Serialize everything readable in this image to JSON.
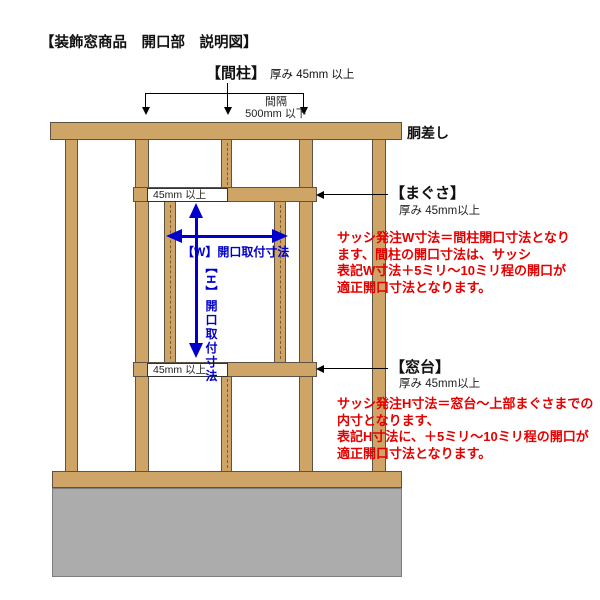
{
  "title": "【装飾窓商品　開口部　説明図】",
  "colors": {
    "wood": "#cfa567",
    "foundation": "#acacac",
    "dimension_blue": "#0000cc",
    "note_red": "#e50000"
  },
  "top_annotation": {
    "stud_label": "【間柱】",
    "stud_note": "厚み 45mm 以上",
    "spacing_line1": "間隔",
    "spacing_line2": "500mm 以下"
  },
  "labels": {
    "girder": "胴差し",
    "lintel": "【まぐさ】",
    "lintel_note": "厚み 45mm以上",
    "sill": "【窓台】",
    "sill_note": "厚み 45mm以上",
    "min_top": "45mm 以上",
    "min_bottom": "45mm 以上"
  },
  "dimensions": {
    "w_label": "【W】開口取付寸法",
    "h_label": "【H】開口取付寸法"
  },
  "notes": {
    "w_note": "サッシ発注W寸法＝間柱開口寸法となり\nます、間柱の開口寸法は、サッシ\n表記W寸法＋5ミリ〜10ミリ程の開口が\n適正開口寸法となります。",
    "h_note": "サッシ発注H寸法＝窓台〜上部まぐさまでの\n内寸となります、\n表記H寸法に、＋5ミリ〜10ミリ程の開口が\n適正開口寸法となります。"
  }
}
